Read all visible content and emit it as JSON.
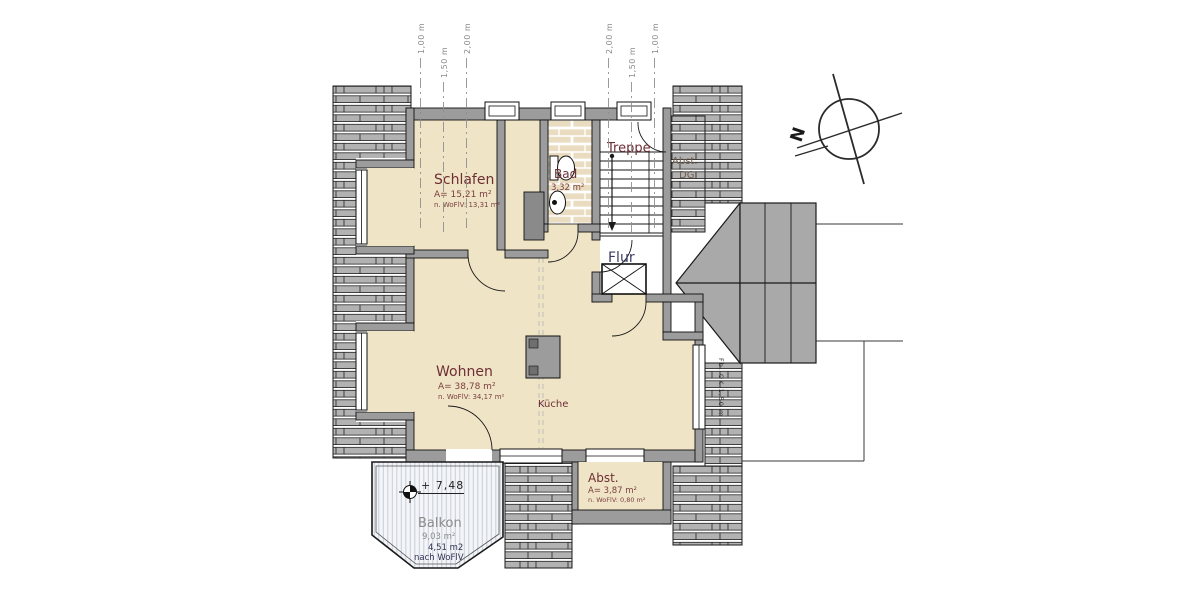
{
  "plan": {
    "rooms": {
      "schlafen": {
        "name": "Schlafen",
        "area": "A= 15,21 m²",
        "wofl": "n. WoFlV: 13,31 m²"
      },
      "bad": {
        "name": "Bad",
        "area": "3,32 m²"
      },
      "treppe": {
        "name": "Treppe"
      },
      "abst_dg": {
        "line1": "Abst.",
        "line2": "DG"
      },
      "flur": {
        "name": "Flur"
      },
      "wohnen": {
        "name": "Wohnen",
        "area": "A= 38,78 m²",
        "wofl": "n. WoFlV: 34,17 m²"
      },
      "kueche": {
        "name": "Küche"
      },
      "abst": {
        "name": "Abst.",
        "area": "A= 3,87 m²",
        "wofl": "n. WoFlV: 0,80 m²"
      },
      "balkon": {
        "name": "Balkon",
        "area": "9,03 m²",
        "area_alt": "4,51 m2",
        "area_alt_note": "nach WoFlV"
      }
    },
    "annotations": {
      "level": "+ 7,48",
      "north": "N",
      "edge_note": "Fb. OK 1,50 m"
    },
    "roof_height_labels": {
      "left": [
        "1,00 m",
        "1,50 m",
        "2,00 m"
      ],
      "right": [
        "2,00 m",
        "1,50 m",
        "1,00 m"
      ]
    },
    "colors": {
      "room_fill": "#f0e4c6",
      "roof": "#b2b2b2",
      "wall": "#9c9c9c",
      "balcony": "#f3f5f8",
      "label_red": "#6d2e34",
      "flur_label": "#3c3c64",
      "gray_text": "#8b8b8b"
    }
  }
}
